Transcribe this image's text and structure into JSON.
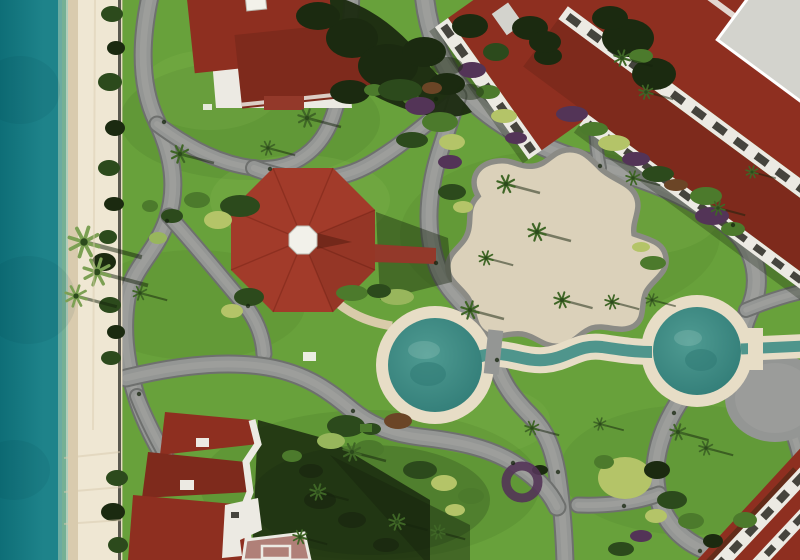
{
  "scene": {
    "elements": [
      "ocean",
      "shoreline-foam",
      "beach-sand",
      "seawall",
      "resort-lawn",
      "walking-path-network",
      "octagonal-gazebo",
      "gazebo-cupola",
      "red-walkway",
      "event-plaza",
      "west-circular-pool",
      "east-circular-pool",
      "lazy-river-channel",
      "pool-bridge",
      "villa-building",
      "hotel-wing-northwest",
      "hotel-wing-northeast",
      "hotel-building-southwest",
      "hotel-building-southeast",
      "palm-trees",
      "shrubs",
      "flower-beds",
      "building-shadows"
    ]
  },
  "colors": {
    "ocean_deep": "#0e6e77",
    "ocean_mid": "#1e838a",
    "ocean_shallow": "#79b3a4",
    "foam": "#dfe8da",
    "sand": "#efe7d3",
    "sand_wet": "#d9cbae",
    "sand_shade": "#e3d8bf",
    "seawall": "#3f3e36",
    "grass": "#68a13b",
    "grass_dark": "#3e6b24",
    "grass_light": "#8dbf55",
    "path": "#949694",
    "path_edge": "#6e706e",
    "path_worn": "#a6a6a2",
    "plaza_fill": "#dbd1ba",
    "plaza_edge": "#8b8b85",
    "roof_red": "#8e2f20",
    "roof_red_dark": "#7e2a1c",
    "roof_pink": "#b08078",
    "wall_white": "#eceae3",
    "balcony_inset": "#45443d",
    "flat_roof_gray": "#d3d3cd",
    "gazebo_roof": "#a23b2a",
    "gazebo_ridge": "#7c2718",
    "cupola_white": "#f2f1ea",
    "walkway_red": "#93392a",
    "pool_ring": "#e7ddc6",
    "pool_water": "#4f9b92",
    "pool_water_deep": "#2f7a75",
    "channel_water": "#4f958c",
    "tan_path": "#d9cbaa",
    "tree_dark": "#1b2a10",
    "bush_dark": "#2c4a1c",
    "bush_mid": "#4c7a2c",
    "bush_light": "#98b65c",
    "bush_yellow": "#b4c468",
    "flower_purple": "#533457",
    "flower_rust": "#6b4526",
    "shadow": "#16240d",
    "palm_frond": "#3f6626",
    "palm_frond_light": "#7ca053"
  },
  "paths": [
    {
      "d": "M151,-8 C140,40 139,85 157,122 C173,156 178,188 167,220 C155,254 133,267 127,298 C122,328 125,358 135,392 C141,413 152,438 166,460",
      "w": 15
    },
    {
      "d": "M157,124 C192,150 222,164 254,168",
      "w": 13
    },
    {
      "d": "M254,168 C295,172 322,148 333,116 C344,85 350,52 352,-8",
      "w": 13
    },
    {
      "d": "M254,168 C300,186 340,182 372,163 C404,144 430,120 452,103",
      "w": 14
    },
    {
      "d": "M424,-8 C427,28 440,66 466,94 C496,126 546,152 600,166 C655,181 700,201 731,227 C757,249 763,283 749,311 C744,322 740,336 739,350",
      "w": 17
    },
    {
      "d": "M458,96 C447,132 436,158 432,184 C427,212 428,238 436,262 C444,288 460,300 474,316 C487,330 492,344 495,358 C500,382 515,400 531,416 C547,432 553,450 557,472 C561,497 564,530 565,562",
      "w": 15
    },
    {
      "d": "M169,216 C196,246 222,278 244,304 C256,319 263,336 264,354",
      "w": 13
    },
    {
      "d": "M126,378 C175,366 225,360 267,367 C308,374 330,392 352,410 C374,428 396,434 420,437 C456,441 487,447 512,462 C534,475 549,490 557,507",
      "w": 15
    },
    {
      "d": "M739,350 C710,363 688,385 673,412 C658,439 652,466 657,492 C662,518 678,538 703,549 C730,561 765,558 795,545",
      "w": 16
    },
    {
      "d": "M659,494 C635,503 605,506 578,505",
      "w": 13
    },
    {
      "d": "M746,310 C768,301 786,295 806,291",
      "w": 12
    },
    {
      "d": "M751,362 C770,382 783,406 792,430 C798,446 801,458 802,470",
      "w": 13
    },
    {
      "d": "M600,168 C594,140 594,112 599,88 C602,76 604,64 605,52",
      "w": 10
    },
    {
      "d": "M137,396 C148,424 160,446 172,466",
      "w": 12
    }
  ],
  "grass_patches": [
    {
      "x": 250,
      "y": 120,
      "rx": 130,
      "ry": 60,
      "c": "grass_dark",
      "o": 0.16
    },
    {
      "x": 560,
      "y": 235,
      "rx": 160,
      "ry": 85,
      "c": "grass_dark",
      "o": 0.12
    },
    {
      "x": 370,
      "y": 485,
      "rx": 170,
      "ry": 75,
      "c": "grass_dark",
      "o": 0.18
    },
    {
      "x": 690,
      "y": 470,
      "rx": 130,
      "ry": 65,
      "c": "grass_dark",
      "o": 0.13
    },
    {
      "x": 195,
      "y": 305,
      "rx": 110,
      "ry": 55,
      "c": "grass_dark",
      "o": 0.12
    },
    {
      "x": 300,
      "y": 200,
      "rx": 90,
      "ry": 45,
      "c": "grass_light",
      "o": 0.2
    },
    {
      "x": 640,
      "y": 215,
      "rx": 80,
      "ry": 40,
      "c": "grass_light",
      "o": 0.18
    },
    {
      "x": 480,
      "y": 420,
      "rx": 70,
      "ry": 35,
      "c": "grass_light",
      "o": 0.15
    },
    {
      "x": 210,
      "y": 90,
      "rx": 70,
      "ry": 40,
      "c": "grass_light",
      "o": 0.18
    }
  ],
  "bushes": [
    {
      "x": 112,
      "y": 14,
      "rx": 11,
      "ry": 8,
      "c": "bush_dark"
    },
    {
      "x": 116,
      "y": 48,
      "rx": 9,
      "ry": 7,
      "c": "tree_dark"
    },
    {
      "x": 110,
      "y": 82,
      "rx": 12,
      "ry": 9,
      "c": "bush_dark"
    },
    {
      "x": 115,
      "y": 128,
      "rx": 10,
      "ry": 8,
      "c": "tree_dark"
    },
    {
      "x": 109,
      "y": 168,
      "rx": 11,
      "ry": 8,
      "c": "bush_dark"
    },
    {
      "x": 114,
      "y": 204,
      "rx": 10,
      "ry": 7,
      "c": "tree_dark"
    },
    {
      "x": 108,
      "y": 237,
      "rx": 9,
      "ry": 7,
      "c": "bush_dark"
    },
    {
      "x": 104,
      "y": 262,
      "rx": 12,
      "ry": 9,
      "c": "tree_dark"
    },
    {
      "x": 110,
      "y": 305,
      "rx": 11,
      "ry": 8,
      "c": "bush_dark"
    },
    {
      "x": 116,
      "y": 332,
      "rx": 9,
      "ry": 7,
      "c": "tree_dark"
    },
    {
      "x": 111,
      "y": 358,
      "rx": 10,
      "ry": 7,
      "c": "bush_dark"
    },
    {
      "x": 117,
      "y": 478,
      "rx": 11,
      "ry": 8,
      "c": "bush_dark"
    },
    {
      "x": 113,
      "y": 512,
      "rx": 12,
      "ry": 9,
      "c": "tree_dark"
    },
    {
      "x": 118,
      "y": 545,
      "rx": 10,
      "ry": 8,
      "c": "bush_dark"
    },
    {
      "x": 240,
      "y": 206,
      "rx": 20,
      "ry": 11,
      "c": "bush_dark"
    },
    {
      "x": 218,
      "y": 220,
      "rx": 14,
      "ry": 9,
      "c": "bush_yellow"
    },
    {
      "x": 197,
      "y": 200,
      "rx": 13,
      "ry": 8,
      "c": "bush_mid"
    },
    {
      "x": 172,
      "y": 216,
      "rx": 11,
      "ry": 7,
      "c": "bush_dark"
    },
    {
      "x": 158,
      "y": 238,
      "rx": 9,
      "ry": 6,
      "c": "bush_light"
    },
    {
      "x": 150,
      "y": 206,
      "rx": 8,
      "ry": 6,
      "c": "bush_mid"
    },
    {
      "x": 249,
      "y": 297,
      "rx": 15,
      "ry": 9,
      "c": "bush_dark"
    },
    {
      "x": 232,
      "y": 311,
      "rx": 11,
      "ry": 7,
      "c": "bush_yellow"
    },
    {
      "x": 352,
      "y": 293,
      "rx": 16,
      "ry": 8,
      "c": "bush_mid"
    },
    {
      "x": 352,
      "y": 38,
      "rx": 26,
      "ry": 20,
      "c": "tree_dark"
    },
    {
      "x": 388,
      "y": 66,
      "rx": 30,
      "ry": 22,
      "c": "tree_dark"
    },
    {
      "x": 424,
      "y": 52,
      "rx": 22,
      "ry": 15,
      "c": "tree_dark"
    },
    {
      "x": 350,
      "y": 92,
      "rx": 20,
      "ry": 12,
      "c": "tree_dark"
    },
    {
      "x": 447,
      "y": 84,
      "rx": 18,
      "ry": 11,
      "c": "tree_dark"
    },
    {
      "x": 318,
      "y": 16,
      "rx": 22,
      "ry": 14,
      "c": "tree_dark"
    },
    {
      "x": 374,
      "y": 90,
      "rx": 10,
      "ry": 6,
      "c": "bush_mid"
    },
    {
      "x": 412,
      "y": 100,
      "rx": 9,
      "ry": 5,
      "c": "bush_mid"
    },
    {
      "x": 470,
      "y": 26,
      "rx": 18,
      "ry": 12,
      "c": "tree_dark"
    },
    {
      "x": 496,
      "y": 52,
      "rx": 13,
      "ry": 9,
      "c": "bush_dark"
    },
    {
      "x": 530,
      "y": 28,
      "rx": 18,
      "ry": 12,
      "c": "tree_dark"
    },
    {
      "x": 548,
      "y": 56,
      "rx": 14,
      "ry": 9,
      "c": "tree_dark"
    },
    {
      "x": 545,
      "y": 42,
      "rx": 16,
      "ry": 11,
      "c": "tree_dark"
    },
    {
      "x": 400,
      "y": 90,
      "rx": 22,
      "ry": 11,
      "c": "bush_dark"
    },
    {
      "x": 420,
      "y": 106,
      "rx": 15,
      "ry": 9,
      "c": "flower_purple"
    },
    {
      "x": 440,
      "y": 122,
      "rx": 18,
      "ry": 10,
      "c": "bush_mid"
    },
    {
      "x": 452,
      "y": 142,
      "rx": 13,
      "ry": 8,
      "c": "bush_yellow"
    },
    {
      "x": 432,
      "y": 88,
      "rx": 10,
      "ry": 6,
      "c": "flower_rust"
    },
    {
      "x": 412,
      "y": 140,
      "rx": 16,
      "ry": 8,
      "c": "bush_dark"
    },
    {
      "x": 450,
      "y": 162,
      "rx": 12,
      "ry": 7,
      "c": "flower_purple"
    },
    {
      "x": 472,
      "y": 70,
      "rx": 14,
      "ry": 8,
      "c": "flower_purple"
    },
    {
      "x": 488,
      "y": 92,
      "rx": 12,
      "ry": 7,
      "c": "bush_mid"
    },
    {
      "x": 504,
      "y": 116,
      "rx": 13,
      "ry": 7,
      "c": "bush_yellow"
    },
    {
      "x": 516,
      "y": 138,
      "rx": 11,
      "ry": 6,
      "c": "flower_purple"
    },
    {
      "x": 572,
      "y": 114,
      "rx": 16,
      "ry": 8,
      "c": "flower_purple"
    },
    {
      "x": 594,
      "y": 129,
      "rx": 14,
      "ry": 7,
      "c": "bush_mid"
    },
    {
      "x": 614,
      "y": 143,
      "rx": 16,
      "ry": 8,
      "c": "bush_yellow"
    },
    {
      "x": 636,
      "y": 159,
      "rx": 14,
      "ry": 7,
      "c": "flower_purple"
    },
    {
      "x": 658,
      "y": 174,
      "rx": 16,
      "ry": 8,
      "c": "bush_dark"
    },
    {
      "x": 676,
      "y": 185,
      "rx": 12,
      "ry": 6,
      "c": "flower_rust"
    },
    {
      "x": 706,
      "y": 196,
      "rx": 16,
      "ry": 9,
      "c": "bush_mid"
    },
    {
      "x": 712,
      "y": 216,
      "rx": 17,
      "ry": 9,
      "c": "flower_purple"
    },
    {
      "x": 733,
      "y": 229,
      "rx": 12,
      "ry": 7,
      "c": "bush_mid"
    },
    {
      "x": 628,
      "y": 38,
      "rx": 26,
      "ry": 19,
      "c": "tree_dark"
    },
    {
      "x": 654,
      "y": 74,
      "rx": 22,
      "ry": 16,
      "c": "tree_dark"
    },
    {
      "x": 610,
      "y": 18,
      "rx": 18,
      "ry": 12,
      "c": "tree_dark"
    },
    {
      "x": 641,
      "y": 56,
      "rx": 12,
      "ry": 7,
      "c": "bush_mid"
    },
    {
      "x": 452,
      "y": 192,
      "rx": 14,
      "ry": 8,
      "c": "bush_dark"
    },
    {
      "x": 463,
      "y": 207,
      "rx": 10,
      "ry": 6,
      "c": "bush_yellow"
    },
    {
      "x": 653,
      "y": 263,
      "rx": 13,
      "ry": 7,
      "c": "bush_mid"
    },
    {
      "x": 641,
      "y": 247,
      "rx": 9,
      "ry": 5,
      "c": "bush_yellow"
    },
    {
      "x": 397,
      "y": 297,
      "rx": 17,
      "ry": 8,
      "c": "bush_light"
    },
    {
      "x": 379,
      "y": 291,
      "rx": 12,
      "ry": 7,
      "c": "bush_dark"
    },
    {
      "x": 398,
      "y": 421,
      "rx": 14,
      "ry": 8,
      "c": "flower_rust"
    },
    {
      "x": 371,
      "y": 429,
      "rx": 10,
      "ry": 6,
      "c": "bush_dark"
    },
    {
      "x": 420,
      "y": 470,
      "rx": 17,
      "ry": 9,
      "c": "bush_dark"
    },
    {
      "x": 444,
      "y": 483,
      "rx": 13,
      "ry": 8,
      "c": "bush_yellow"
    },
    {
      "x": 346,
      "y": 426,
      "rx": 19,
      "ry": 11,
      "c": "bush_dark"
    },
    {
      "x": 331,
      "y": 441,
      "rx": 14,
      "ry": 8,
      "c": "bush_light"
    },
    {
      "x": 369,
      "y": 449,
      "rx": 15,
      "ry": 9,
      "c": "bush_mid"
    },
    {
      "x": 311,
      "y": 471,
      "rx": 12,
      "ry": 7,
      "c": "tree_dark"
    },
    {
      "x": 292,
      "y": 456,
      "rx": 10,
      "ry": 6,
      "c": "bush_mid"
    },
    {
      "x": 471,
      "y": 496,
      "rx": 13,
      "ry": 8,
      "c": "bush_mid"
    },
    {
      "x": 455,
      "y": 510,
      "rx": 10,
      "ry": 6,
      "c": "bush_yellow"
    },
    {
      "x": 625,
      "y": 478,
      "rx": 27,
      "ry": 21,
      "c": "bush_yellow"
    },
    {
      "x": 657,
      "y": 470,
      "rx": 13,
      "ry": 9,
      "c": "tree_dark"
    },
    {
      "x": 604,
      "y": 462,
      "rx": 10,
      "ry": 7,
      "c": "bush_mid"
    },
    {
      "x": 540,
      "y": 470,
      "rx": 8,
      "ry": 5,
      "c": "tree_dark"
    },
    {
      "x": 672,
      "y": 500,
      "rx": 15,
      "ry": 9,
      "c": "bush_dark"
    },
    {
      "x": 656,
      "y": 516,
      "rx": 11,
      "ry": 7,
      "c": "bush_yellow"
    },
    {
      "x": 691,
      "y": 521,
      "rx": 13,
      "ry": 8,
      "c": "bush_mid"
    },
    {
      "x": 641,
      "y": 536,
      "rx": 11,
      "ry": 6,
      "c": "flower_purple"
    },
    {
      "x": 713,
      "y": 541,
      "rx": 10,
      "ry": 7,
      "c": "tree_dark"
    },
    {
      "x": 621,
      "y": 549,
      "rx": 13,
      "ry": 7,
      "c": "bush_dark"
    },
    {
      "x": 745,
      "y": 520,
      "rx": 12,
      "ry": 8,
      "c": "bush_mid"
    },
    {
      "x": 320,
      "y": 500,
      "rx": 16,
      "ry": 9,
      "c": "tree_dark"
    },
    {
      "x": 352,
      "y": 520,
      "rx": 14,
      "ry": 8,
      "c": "tree_dark"
    },
    {
      "x": 386,
      "y": 545,
      "rx": 13,
      "ry": 7,
      "c": "tree_dark"
    }
  ],
  "palms": [
    {
      "x": 84,
      "y": 242,
      "s": 1.7,
      "l": 1
    },
    {
      "x": 97,
      "y": 272,
      "s": 1.5,
      "l": 1
    },
    {
      "x": 76,
      "y": 296,
      "s": 1.2,
      "l": 1
    },
    {
      "x": 180,
      "y": 154,
      "s": 1.0
    },
    {
      "x": 307,
      "y": 118,
      "s": 1.0
    },
    {
      "x": 268,
      "y": 148,
      "s": 0.8
    },
    {
      "x": 140,
      "y": 293,
      "s": 0.8
    },
    {
      "x": 506,
      "y": 184,
      "s": 1.0
    },
    {
      "x": 537,
      "y": 232,
      "s": 1.0
    },
    {
      "x": 486,
      "y": 258,
      "s": 0.8
    },
    {
      "x": 562,
      "y": 300,
      "s": 0.9
    },
    {
      "x": 612,
      "y": 302,
      "s": 0.8
    },
    {
      "x": 633,
      "y": 178,
      "s": 0.8
    },
    {
      "x": 470,
      "y": 310,
      "s": 1.0
    },
    {
      "x": 352,
      "y": 452,
      "s": 1.0
    },
    {
      "x": 318,
      "y": 492,
      "s": 0.9
    },
    {
      "x": 397,
      "y": 522,
      "s": 0.9
    },
    {
      "x": 438,
      "y": 532,
      "s": 0.8
    },
    {
      "x": 300,
      "y": 537,
      "s": 0.8
    },
    {
      "x": 678,
      "y": 432,
      "s": 0.9
    },
    {
      "x": 706,
      "y": 448,
      "s": 0.8
    },
    {
      "x": 600,
      "y": 424,
      "s": 0.7
    },
    {
      "x": 622,
      "y": 58,
      "s": 0.9
    },
    {
      "x": 646,
      "y": 92,
      "s": 0.8
    },
    {
      "x": 652,
      "y": 300,
      "s": 0.7
    },
    {
      "x": 718,
      "y": 208,
      "s": 0.8
    },
    {
      "x": 532,
      "y": 428,
      "s": 0.8
    },
    {
      "x": 752,
      "y": 172,
      "s": 0.7
    }
  ],
  "objects": [
    {
      "t": "rect",
      "x": 303,
      "y": 352,
      "w": 13,
      "h": 9,
      "c": "cupola_white",
      "o": 0.95
    },
    {
      "t": "rect",
      "x": 203,
      "y": 104,
      "w": 9,
      "h": 6,
      "c": "cupola_white",
      "o": 0.9
    },
    {
      "t": "rect",
      "x": 360,
      "y": 424,
      "w": 12,
      "h": 8,
      "c": "bush_mid",
      "o": 1
    },
    {
      "t": "line",
      "x1": 95,
      "y1": 0,
      "x2": 93,
      "y2": 430,
      "c": "sand_wet",
      "w": 2,
      "o": 0.45
    },
    {
      "t": "line",
      "x1": 64,
      "y1": 458,
      "x2": 120,
      "y2": 452,
      "c": "sand_wet",
      "w": 2,
      "o": 0.5
    },
    {
      "t": "line",
      "x1": 64,
      "y1": 492,
      "x2": 122,
      "y2": 487,
      "c": "sand_wet",
      "w": 2,
      "o": 0.5
    },
    {
      "t": "line",
      "x1": 64,
      "y1": 524,
      "x2": 122,
      "y2": 520,
      "c": "sand_wet",
      "w": 2,
      "o": 0.5
    },
    {
      "t": "ell",
      "x": 447,
      "y": 66,
      "rx": 16,
      "ry": 9,
      "c": "tree_dark",
      "o": 0.5
    },
    {
      "t": "ell",
      "x": 470,
      "y": 92,
      "rx": 14,
      "ry": 8,
      "c": "tree_dark",
      "o": 0.45
    },
    {
      "t": "dot",
      "x": 270,
      "y": 169
    },
    {
      "t": "dot",
      "x": 436,
      "y": 99
    },
    {
      "t": "dot",
      "x": 600,
      "y": 166
    },
    {
      "t": "dot",
      "x": 733,
      "y": 225
    },
    {
      "t": "dot",
      "x": 497,
      "y": 360
    },
    {
      "t": "dot",
      "x": 558,
      "y": 472
    },
    {
      "t": "dot",
      "x": 167,
      "y": 221
    },
    {
      "t": "dot",
      "x": 248,
      "y": 306
    },
    {
      "t": "dot",
      "x": 353,
      "y": 411
    },
    {
      "t": "dot",
      "x": 513,
      "y": 463
    },
    {
      "t": "dot",
      "x": 674,
      "y": 413
    },
    {
      "t": "dot",
      "x": 436,
      "y": 263
    },
    {
      "t": "dot",
      "x": 164,
      "y": 122
    },
    {
      "t": "dot",
      "x": 624,
      "y": 506
    },
    {
      "t": "dot",
      "x": 700,
      "y": 551
    },
    {
      "t": "dot",
      "x": 139,
      "y": 394
    }
  ]
}
